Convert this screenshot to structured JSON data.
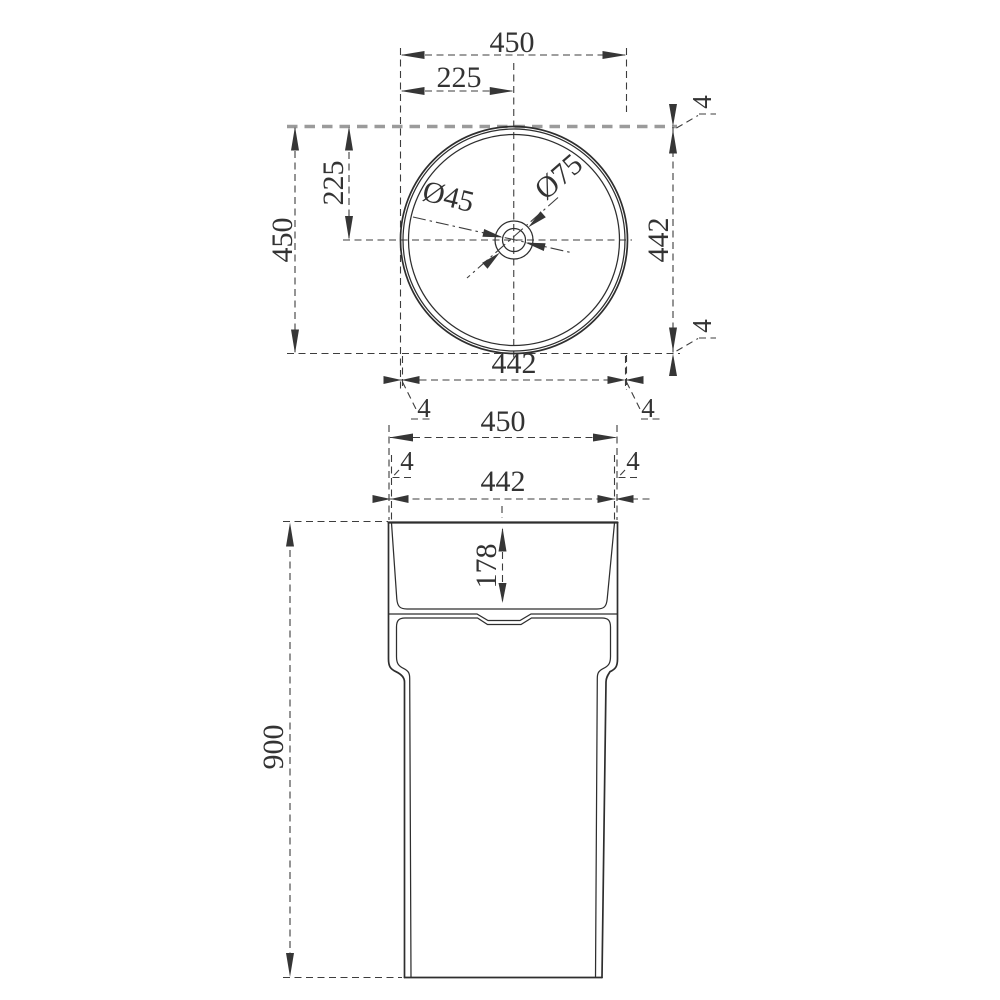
{
  "drawing": {
    "type": "technical dimension drawing",
    "subject": "round pedestal wash basin, top view and front view"
  },
  "top_view": {
    "dim_outer_width": "450",
    "dim_half_width": "225",
    "dim_half_height": "225",
    "dim_outer_height": "450",
    "dim_inner_height": "442",
    "dim_inner_width": "442",
    "dim_wall_top": "4",
    "dim_wall_bottom": "4",
    "dim_wall_bottom_left": "4",
    "dim_wall_bottom_right": "4",
    "dim_drain_inner": "Ø45",
    "dim_drain_outer": "Ø75"
  },
  "front_view": {
    "dim_outer_width": "450",
    "dim_wall_left": "4",
    "dim_wall_right": "4",
    "dim_inner_width": "442",
    "dim_basin_depth": "178",
    "dim_total_height": "900"
  }
}
